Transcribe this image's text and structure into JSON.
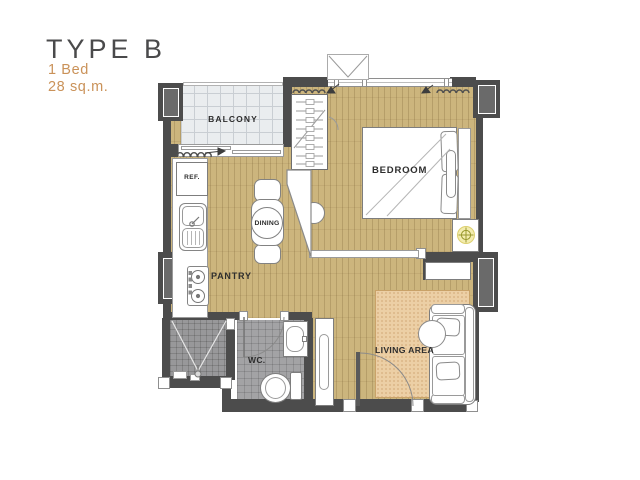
{
  "title": "TYPE B",
  "unit_info": {
    "beds": "1 Bed",
    "area": "28 sq.m."
  },
  "room_labels": {
    "balcony": "BALCONY",
    "bedroom": "BEDROOM",
    "dining": "DINING",
    "pantry": "PANTRY",
    "wc": "WC.",
    "living_area": "LIVING AREA"
  },
  "appliance_labels": {
    "refrigerator": "REF."
  },
  "colors": {
    "title_text": "#4a4a4b",
    "accent_orange": "#ca9259",
    "wall": "#4c4c4c",
    "wood_floor": "#ccb57d",
    "balcony_tile": "#eaedef",
    "bath_tile": "#a3a3a5",
    "rug": "#eccfa5",
    "lamp_accent": "#b5ae3f"
  }
}
